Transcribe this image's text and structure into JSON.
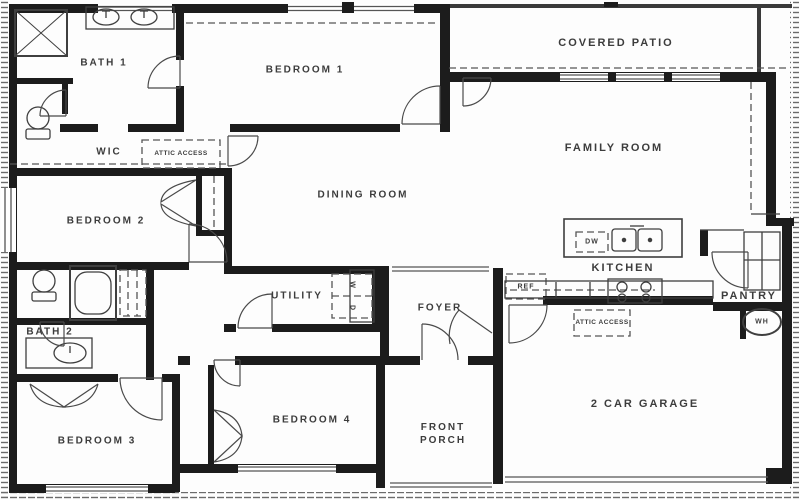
{
  "rooms": {
    "covered_patio": "COVERED PATIO",
    "family_room": "FAMILY ROOM",
    "bedroom1": "BEDROOM 1",
    "bath1": "BATH 1",
    "wic": "WIC",
    "bedroom2": "BEDROOM 2",
    "dining_room": "DINING ROOM",
    "kitchen": "KITCHEN",
    "utility": "UTILITY",
    "foyer": "FOYER",
    "pantry": "PANTRY",
    "bath2": "BATH 2",
    "bedroom3": "BEDROOM 3",
    "bedroom4": "BEDROOM 4",
    "front_porch": "FRONT PORCH",
    "garage": "2 CAR GARAGE"
  },
  "fixtures": {
    "attic_access": "ATTIC ACCESS",
    "water_heater": "WH",
    "dishwasher": "DW",
    "refrigerator": "REF",
    "washer": "W",
    "dryer": "D"
  },
  "colors": {
    "wall": "#1c1c1c",
    "line": "#4d4d4d",
    "label": "#3c3c3c",
    "background": "#fdfdfd"
  }
}
